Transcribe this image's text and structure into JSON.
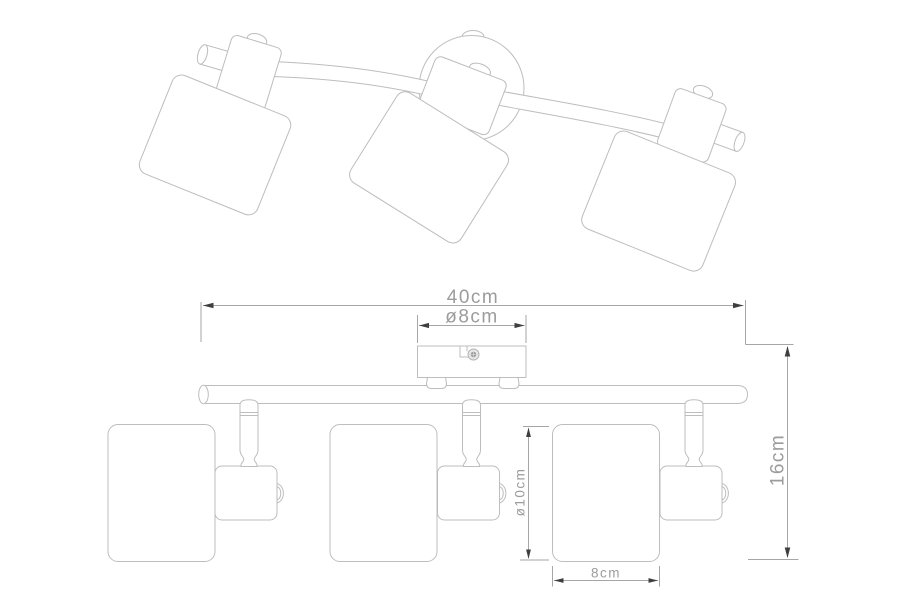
{
  "drawing": {
    "subject": "three-light ceiling spotlight bar",
    "lamp_count": 3,
    "views": [
      "perspective",
      "front-elevation"
    ]
  },
  "colors": {
    "background": "#ffffff",
    "outline": "#bdbdbd",
    "dimension_line": "#a6a6a6",
    "arrow": "#3f3f3f",
    "label_text": "#9c9c9c"
  },
  "dimensions": {
    "bar_length": "40cm",
    "canopy_diameter": "ø8cm",
    "fixture_height": "16cm",
    "shade_diameter": "ø10cm",
    "shade_width": "8cm"
  }
}
